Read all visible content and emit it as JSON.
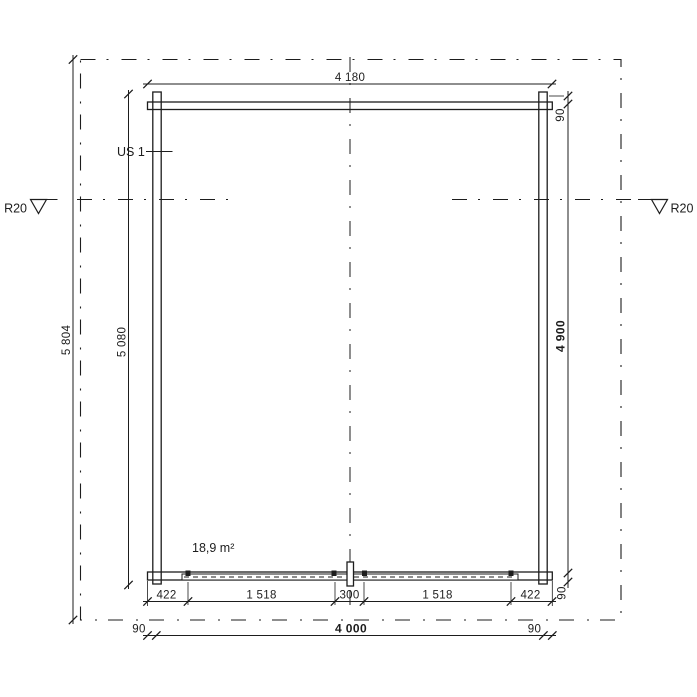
{
  "drawing": {
    "labels": {
      "wall_section": "US 1",
      "floor_area": "18,9 m²",
      "roof_datum_left": "R20",
      "roof_datum_right": "R20"
    },
    "dims": {
      "top_total": "4 180",
      "left_total": "5 804",
      "left_inner": "5 080",
      "right_top_overhang": "90",
      "right_inner": "4 900",
      "right_bottom_overhang": "90",
      "bottom_chain": [
        "422",
        "1 518",
        "300",
        "1 518",
        "422"
      ],
      "bottom_left_overhang": "90",
      "bottom_total": "4 000",
      "bottom_right_overhang": "90"
    },
    "colors": {
      "line": "#1d1d1d",
      "background": "#ffffff"
    }
  }
}
